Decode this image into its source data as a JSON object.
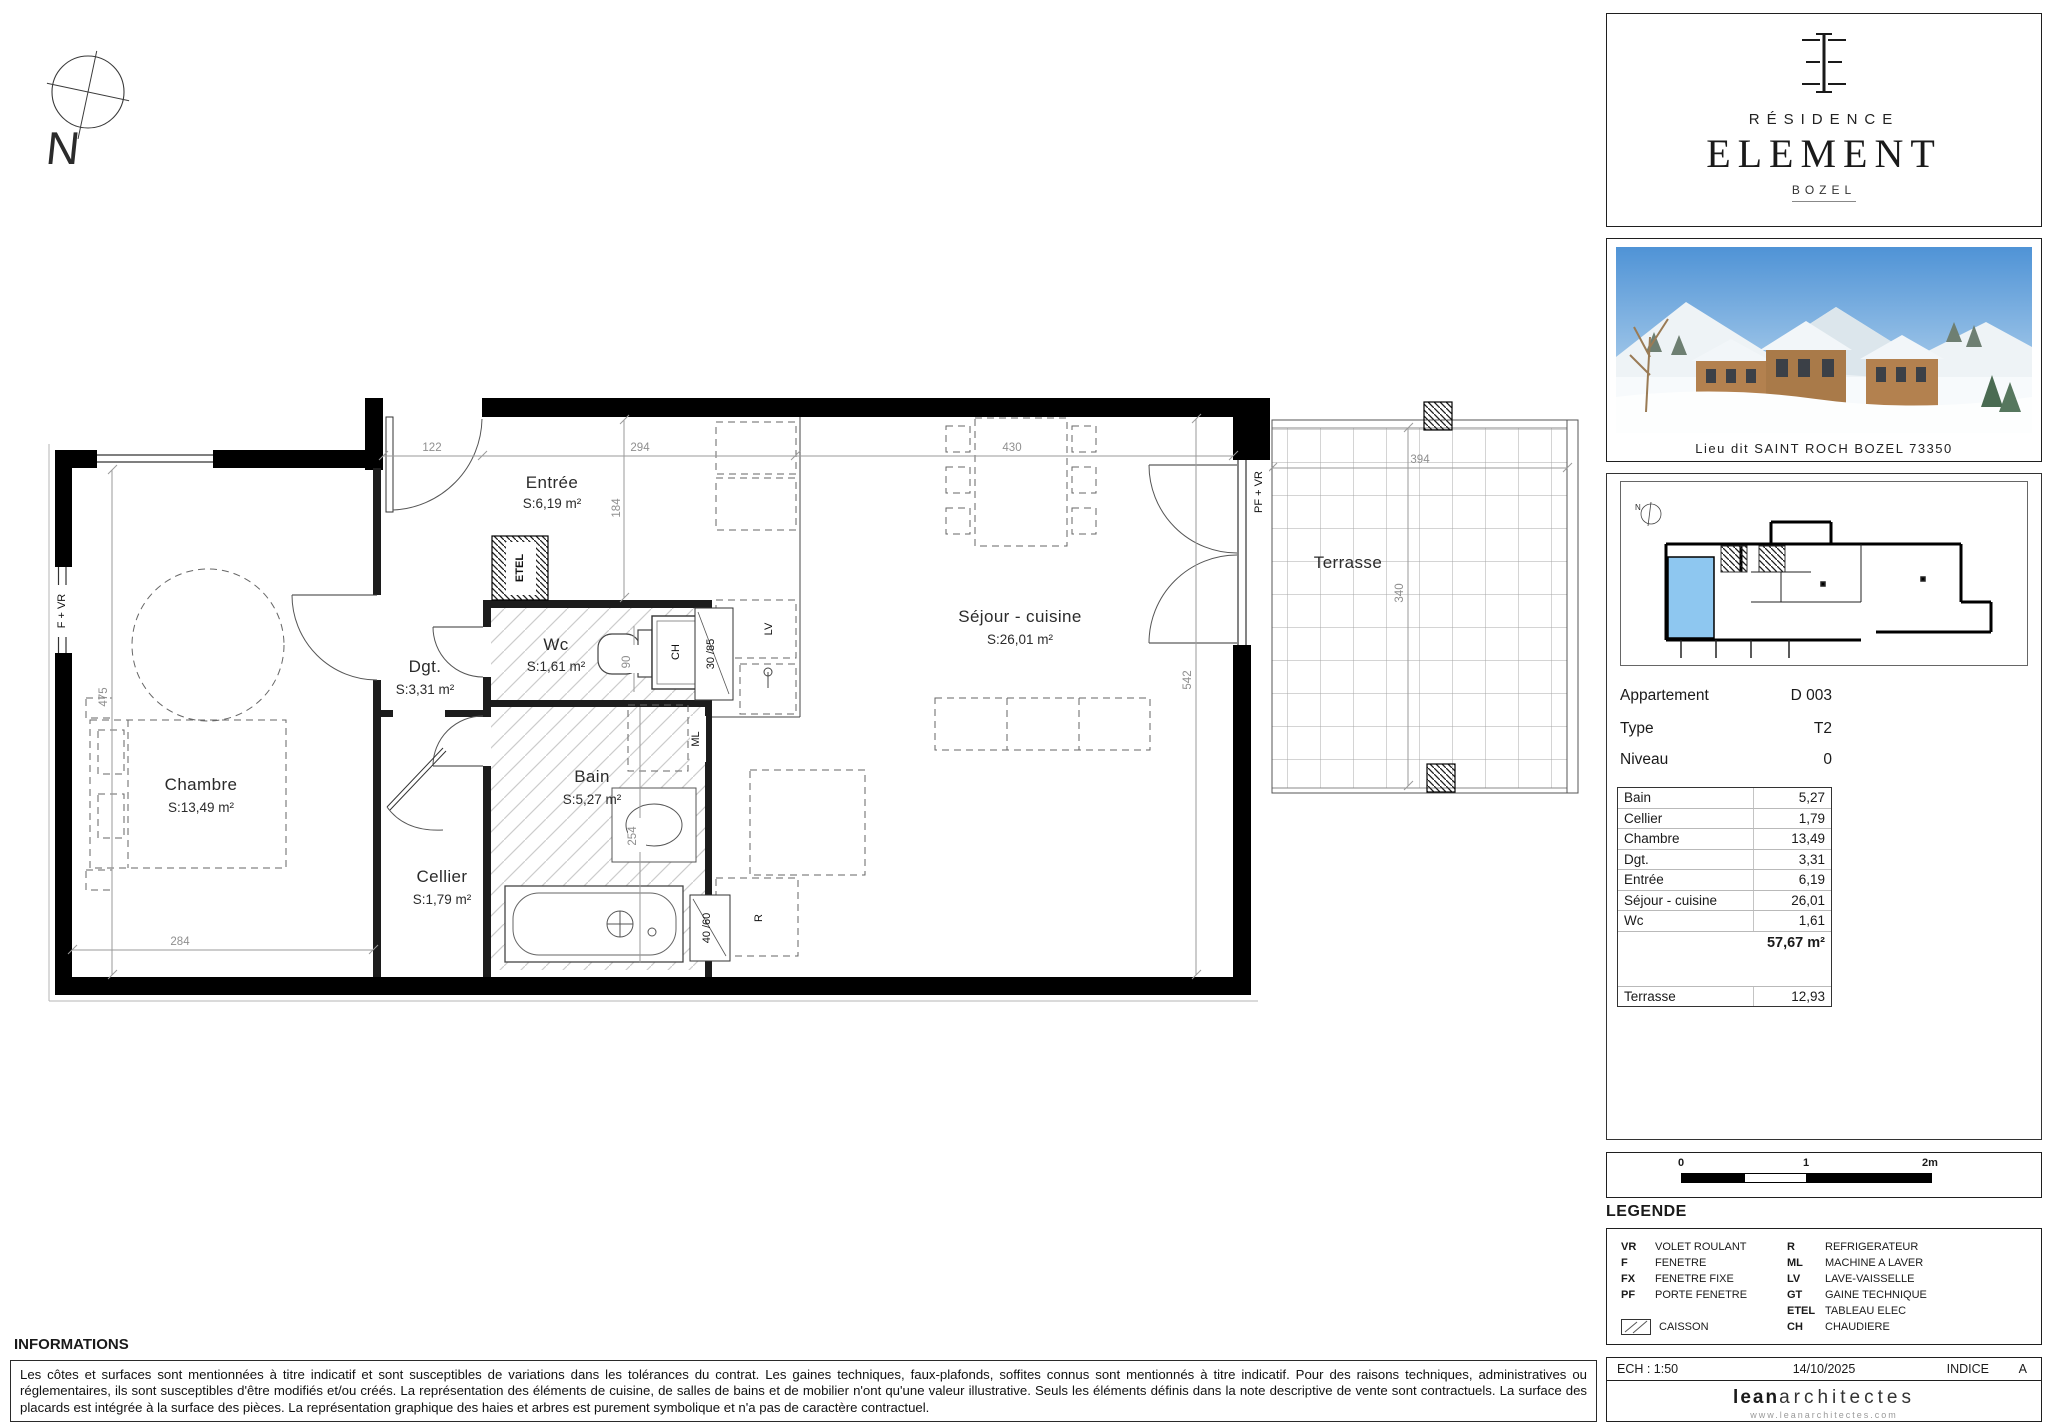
{
  "compass": {
    "label": "N"
  },
  "plan": {
    "rooms": {
      "entree": {
        "name": "Entrée",
        "area": "S:6,19 m²"
      },
      "chambre": {
        "name": "Chambre",
        "area": "S:13,49 m²"
      },
      "dgt": {
        "name": "Dgt.",
        "area": "S:3,31 m²"
      },
      "wc": {
        "name": "Wc",
        "area": "S:1,61 m²"
      },
      "bain": {
        "name": "Bain",
        "area": "S:5,27 m²"
      },
      "cellier": {
        "name": "Cellier",
        "area": "S:1,79 m²"
      },
      "sejour": {
        "name": "Séjour - cuisine",
        "area": "S:26,01 m²"
      },
      "terrasse": {
        "name": "Terrasse"
      }
    },
    "dims": {
      "d122": "122",
      "d294": "294",
      "d430": "430",
      "d184": "184",
      "d475": "475",
      "d284": "284",
      "d90": "90",
      "d254": "254",
      "d542": "542",
      "d394": "394",
      "d340": "340"
    },
    "tags": {
      "fvr": "F + VR",
      "pfvr": "PF + VR",
      "etel": "ETEL",
      "ch": "CH",
      "lv": "LV",
      "ml": "ML",
      "r": "R",
      "c3085": "30 /85",
      "c4060": "40 /60"
    }
  },
  "branding": {
    "residence": "RÉSIDENCE",
    "name": "ELEMENT",
    "city": "BOZEL",
    "photo_caption": "Lieu dit SAINT ROCH BOZEL 73350"
  },
  "apartment": {
    "rows": [
      {
        "label": "Appartement",
        "value": "D 003"
      },
      {
        "label": "Type",
        "value": "T2"
      },
      {
        "label": "Niveau",
        "value": "0"
      }
    ]
  },
  "areas": {
    "rows": [
      {
        "label": "Bain",
        "value": "5,27"
      },
      {
        "label": "Cellier",
        "value": "1,79"
      },
      {
        "label": "Chambre",
        "value": "13,49"
      },
      {
        "label": "Dgt.",
        "value": "3,31"
      },
      {
        "label": "Entrée",
        "value": "6,19"
      },
      {
        "label": "Séjour - cuisine",
        "value": "26,01"
      },
      {
        "label": "Wc",
        "value": "1,61"
      }
    ],
    "total": "57,67 m²",
    "terrasse": {
      "label": "Terrasse",
      "value": "12,93"
    }
  },
  "scalebar": {
    "t0": "0",
    "t1": "1",
    "t2": "2m"
  },
  "legend": {
    "title": "LEGENDE",
    "left": [
      {
        "abbr": "VR",
        "label": "VOLET ROULANT"
      },
      {
        "abbr": "F",
        "label": "FENETRE"
      },
      {
        "abbr": "FX",
        "label": "FENETRE FIXE"
      },
      {
        "abbr": "PF",
        "label": "PORTE FENETRE"
      }
    ],
    "right": [
      {
        "abbr": "R",
        "label": "REFRIGERATEUR"
      },
      {
        "abbr": "ML",
        "label": "MACHINE A LAVER"
      },
      {
        "abbr": "LV",
        "label": "LAVE-VAISSELLE"
      },
      {
        "abbr": "GT",
        "label": "GAINE TECHNIQUE"
      },
      {
        "abbr": "ETEL",
        "label": "TABLEAU ELEC"
      },
      {
        "abbr": "CH",
        "label": "CHAUDIERE"
      }
    ],
    "caisson": "CAISSON"
  },
  "titleblock": {
    "scale": "ECH : 1:50",
    "date": "14/10/2025",
    "indice_label": "INDICE",
    "indice_value": "A",
    "firm_bold": "lean",
    "firm_light": "architectes",
    "website": "www.leanarchitectes.com"
  },
  "informations": {
    "title": "INFORMATIONS",
    "text": "Les côtes et surfaces sont mentionnées à titre indicatif et sont susceptibles de variations dans les tolérances du contrat. Les gaines techniques, faux-plafonds, soffites connus sont mentionnés à titre indicatif. Pour des raisons techniques, administratives ou réglementaires, ils sont susceptibles d'être modifiés et/ou créés. La représentation des éléments de cuisine, de salles de bains et de mobilier n'ont qu'une valeur illustrative. Seuls les éléments définis dans la note descriptive de vente sont contractuels. La surface des placards est intégrée à la surface des pièces. La représentation graphique des haies et arbres est purement symbolique et n'a pas de caractère contractuel."
  }
}
